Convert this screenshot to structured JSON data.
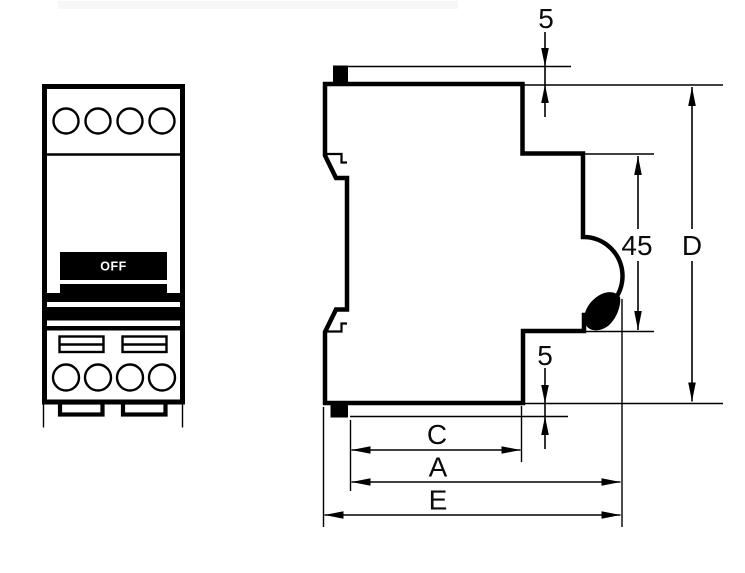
{
  "front_view": {
    "switch_label": "OFF",
    "top_terminal_count": 4,
    "bottom_terminal_count": 4,
    "terminal_slot_count": 2
  },
  "side_view": {
    "dimensions": {
      "top_clip": "5",
      "front_panel_height": "45",
      "body_height": "D",
      "bottom_clip": "5",
      "depth_c": "C",
      "depth_a": "A",
      "depth_e": "E"
    }
  },
  "colors": {
    "line": "#000000",
    "background": "#ffffff",
    "switch_fill": "#000000",
    "switch_label_color": "#ffffff"
  }
}
